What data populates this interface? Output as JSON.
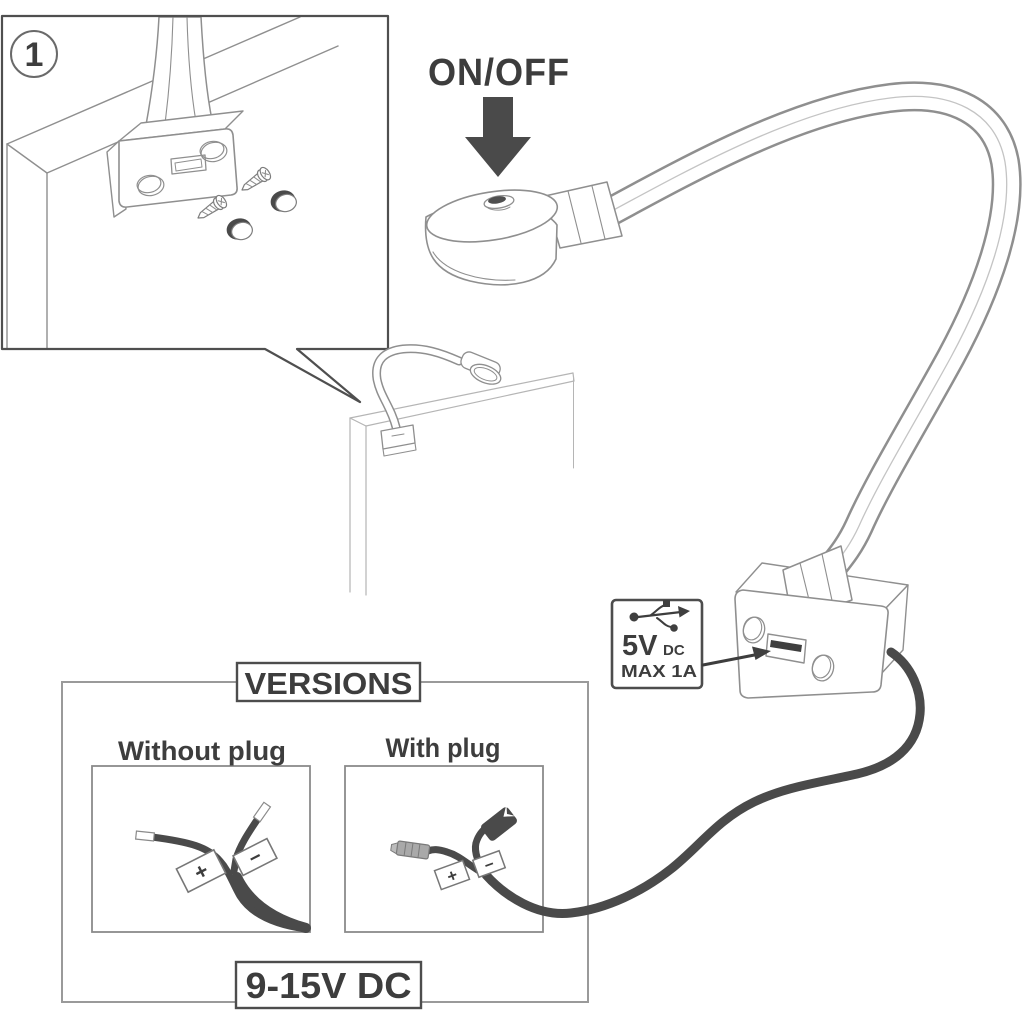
{
  "colors": {
    "line_gray": "#8f8f8f",
    "ink": "#3d3d3d",
    "cable": "#4a4a4a"
  },
  "diagram": {
    "step_badge": "1",
    "power_label": "ON/OFF",
    "usb_callout": {
      "voltage": "5V",
      "voltage_unit": "DC",
      "max_current": "MAX 1A"
    },
    "versions": {
      "title": "VERSIONS",
      "left_variant_label": "Without plug",
      "right_variant_label": "With plug",
      "positive": "+",
      "negative": "−",
      "supply": "9-15V DC"
    }
  }
}
